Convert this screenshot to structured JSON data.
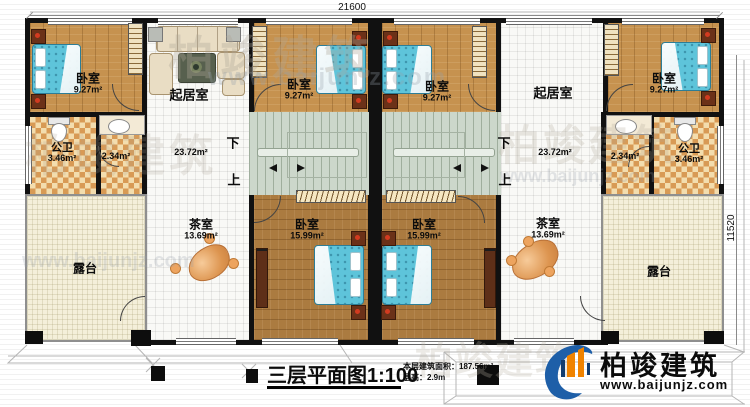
{
  "dimensions": {
    "top": "21600",
    "right": "11520"
  },
  "rooms": {
    "bedroom_small_label": "卧室",
    "bedroom_small_area": "9.27m²",
    "bedroom_large_label": "卧室",
    "bedroom_large_area": "15.99m²",
    "living_label": "起居室",
    "living_area": "23.72m²",
    "bath_label": "公卫",
    "bath_area": "3.46m²",
    "bath_area2": "2.34m²",
    "tea_label": "茶室",
    "tea_area": "13.69m²",
    "terrace_label": "露台"
  },
  "stairs": {
    "down": "下",
    "up": "上"
  },
  "titleblock": {
    "title": "三层平面图1:100",
    "area_line": "本层建筑面积：187.56m²",
    "height_line": "层高：2.9m"
  },
  "branding": {
    "name": "柏竣建筑",
    "url": "www.baijunjz.com"
  }
}
